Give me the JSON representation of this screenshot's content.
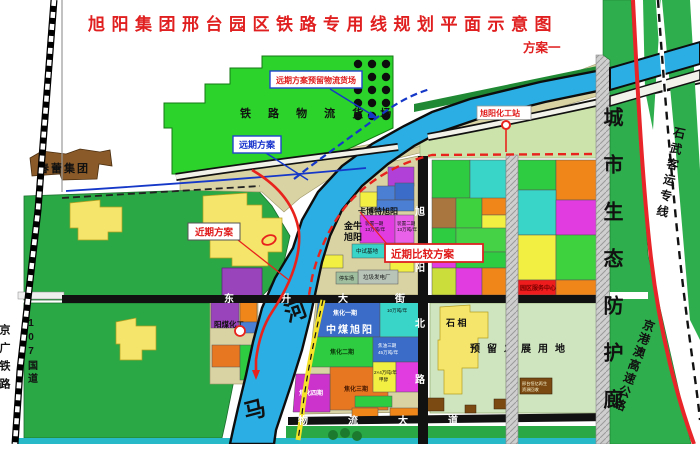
{
  "title": {
    "text": "旭阳集团邢台园区铁路专用线规划平面示意图",
    "scheme": "方案一"
  },
  "callouts": {
    "reserve_yard": "远期方案预留物流货场",
    "long_term": "远期方案",
    "near_term": "近期方案",
    "near_term_compare": "近期比较方案",
    "station": "旭阳化工站"
  },
  "west_side": {
    "jingguang_railway": "京广铁路",
    "highway_107": "107国道",
    "chunlei_group": "春蕾集团"
  },
  "freight_yard": {
    "name": "铁 路 物 流 货 场"
  },
  "river": {
    "upper_char": "河",
    "lower_char": "马"
  },
  "streets": {
    "dongsheng": "东升大街",
    "xuyang_north": "旭阳北路",
    "wuliu": "物流大道"
  },
  "corridor": {
    "name": "城市生态防护廊",
    "shiwu_line": "石武客运专线",
    "expressway": "京港澳高速公路"
  },
  "companies": {
    "zhongmei": "中煤旭阳",
    "jinniu_l1": "金牛",
    "jinniu_l2": "旭阳",
    "cabot": "卡博特旭阳",
    "yangmei": "阳煤化工"
  },
  "blocks": {
    "coking1": "焦化一期",
    "coking2": "焦化二期",
    "coking3": "焦化三期",
    "coking4": "焦化四期",
    "tar3_l1": "焦油三期",
    "tar3_l2": "45万吨/年",
    "methanol_l1": "2×4万吨/年",
    "methanol_l2": "甲醇",
    "benzene": "10万吨/年",
    "unit1_l1": "装置一期",
    "unit1_l2": "13万吨/年",
    "unit2_l1": "装置二期",
    "unit2_l2": "13万吨/年",
    "pilot_base": "中试基地",
    "waste_power": "垃圾发电厂",
    "parking": "停车场",
    "service_center": "园区服务中心"
  },
  "southeast": {
    "shixiang": "石 相",
    "reserved": "预留发展用地",
    "recycle_l1": "邢台恒亿再生",
    "recycle_l2": "资源回收"
  },
  "colors": {
    "accent_red": "#e02020",
    "route_red": "#e8231d",
    "plan_blue": "#1733cc",
    "river_blue": "#2aaee3",
    "yard_green": "#2bd32b",
    "farm_green": "#2aa845",
    "corridor_green": "#2fae4d",
    "khaki": "#d9d3a4"
  }
}
